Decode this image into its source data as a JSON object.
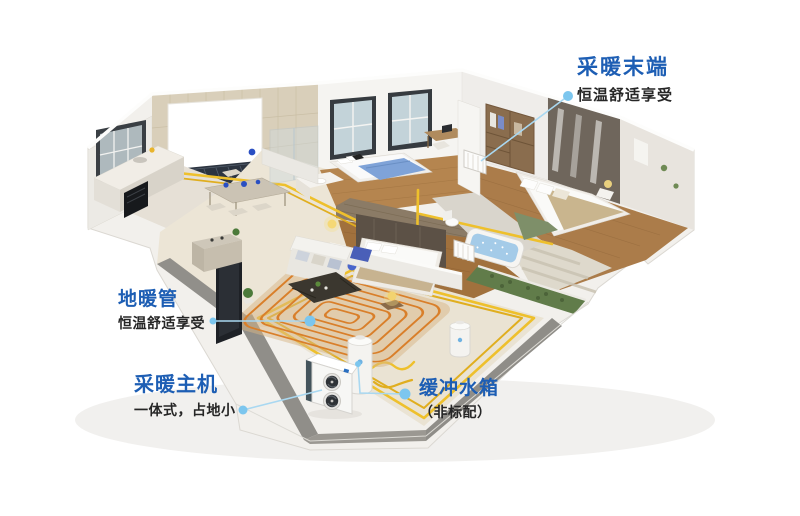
{
  "callouts": {
    "heating_terminal": {
      "title": "采暖末端",
      "subtitle": "恒温舒适享受"
    },
    "floor_heating_pipe": {
      "title": "地暖管",
      "subtitle": "恒温舒适享受"
    },
    "heating_main_unit": {
      "title": "采暖主机",
      "subtitle": "一体式，占地小"
    },
    "buffer_tank": {
      "title": "缓冲水箱",
      "subtitle": "（非标配）"
    }
  },
  "colors": {
    "label_blue": "#1d5eb4",
    "subtitle_dark": "#262626",
    "connector_blue": "#a9d8f1",
    "dot_blue": "#7cc6ee",
    "pipe_yellow": "#eec12f",
    "coil_orange": "#d97f2a",
    "wood_floor": "#b0804c",
    "cream_floor": "#eae3d3"
  },
  "scene_objects": {
    "apartment": "isometric-apartment-cutaway",
    "heat_pump": "outdoor-heat-pump-two-fans",
    "tank": "white-cylinder-buffer-tank",
    "coil": "orange-floor-heating-coil",
    "radiator": "white-radiator-panel"
  }
}
